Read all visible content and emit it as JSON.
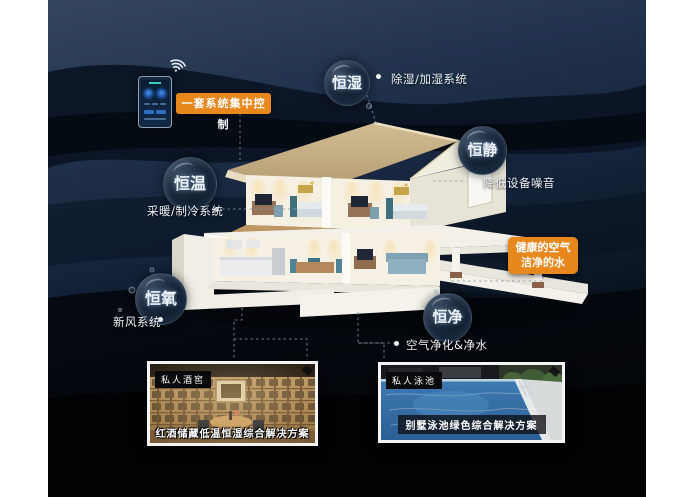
{
  "scene": {
    "type": "smart-home-constant-systems-infographic"
  },
  "control": {
    "label": "一套系统集中控制"
  },
  "bubbles": [
    {
      "label": "恒湿",
      "desc": "除湿/加湿系统"
    },
    {
      "label": "恒静",
      "desc": "降低设备噪音"
    },
    {
      "label": "恒温",
      "desc": "采暖/制冷系统"
    },
    {
      "label": "恒氧",
      "desc": "新风系统"
    },
    {
      "label": "恒净",
      "desc": "空气净化&净水"
    }
  ],
  "highlight": {
    "line1": "健康的空气",
    "line2": "洁净的水"
  },
  "cards": [
    {
      "tag": "私人酒窖",
      "caption": "红酒储藏低温恒湿综合解决方案"
    },
    {
      "tag": "私人泳池",
      "caption": "别墅泳池绿色综合解决方案"
    }
  ],
  "icons": {
    "wifi": "wifi-icon",
    "bullet": "bullet-dot"
  },
  "colors": {
    "accent": "#E8871C",
    "panel_top": "#35465F",
    "panel_bottom": "#020305",
    "connector": "#8A97AB",
    "bubble_core": "#0A1524",
    "roof_tan": "#C8B189",
    "pool_blue": "#3672AA",
    "wood": "#B98E55"
  }
}
